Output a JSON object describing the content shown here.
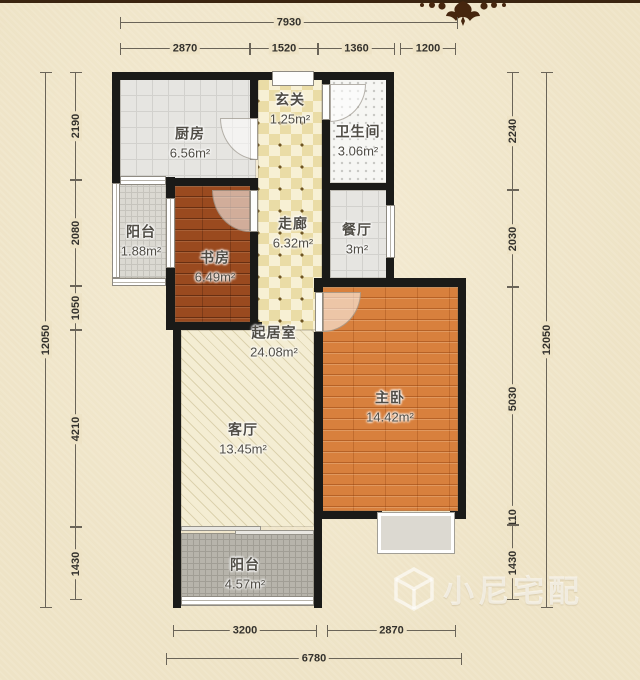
{
  "rooms": [
    {
      "id": "kitchen",
      "name": "厨房",
      "area": "6.56m²"
    },
    {
      "id": "vestibule",
      "name": "玄关",
      "area": "1.25m²"
    },
    {
      "id": "bathroom",
      "name": "卫生间",
      "area": "3.06m²"
    },
    {
      "id": "balcony-left",
      "name": "阳台",
      "area": "1.88m²"
    },
    {
      "id": "study",
      "name": "书房",
      "area": "6.49m²"
    },
    {
      "id": "corridor",
      "name": "走廊",
      "area": "6.32m²"
    },
    {
      "id": "dining",
      "name": "餐厅",
      "area": "3m²"
    },
    {
      "id": "living-core",
      "name": "起居室",
      "area": "24.08m²"
    },
    {
      "id": "living",
      "name": "客厅",
      "area": "13.45m²"
    },
    {
      "id": "master-bedroom",
      "name": "主卧",
      "area": "14.42m²"
    },
    {
      "id": "balcony-bottom",
      "name": "阳台",
      "area": "4.57m²"
    }
  ],
  "dimensions": {
    "top": {
      "total": "7930",
      "segments": [
        "2870",
        "1520",
        "1360",
        "1200"
      ]
    },
    "bottom": {
      "total": "6780",
      "segments": [
        "3200",
        "2870"
      ]
    },
    "left": {
      "total": "12050",
      "segments": [
        "2190",
        "2080",
        "1050",
        "4210",
        "1430"
      ]
    },
    "right": {
      "total": "12050",
      "segments": [
        "2240",
        "2030",
        "5030",
        "110",
        "1430"
      ]
    }
  },
  "watermark": {
    "text": "小尼宅配"
  },
  "colors": {
    "background": "#eee3c6",
    "wall": "#1a1a18",
    "study_wood": "#9a4a1f",
    "master_wood": "#d8803d",
    "corridor_tile": "#eadca6",
    "ornament": "#46260e"
  }
}
